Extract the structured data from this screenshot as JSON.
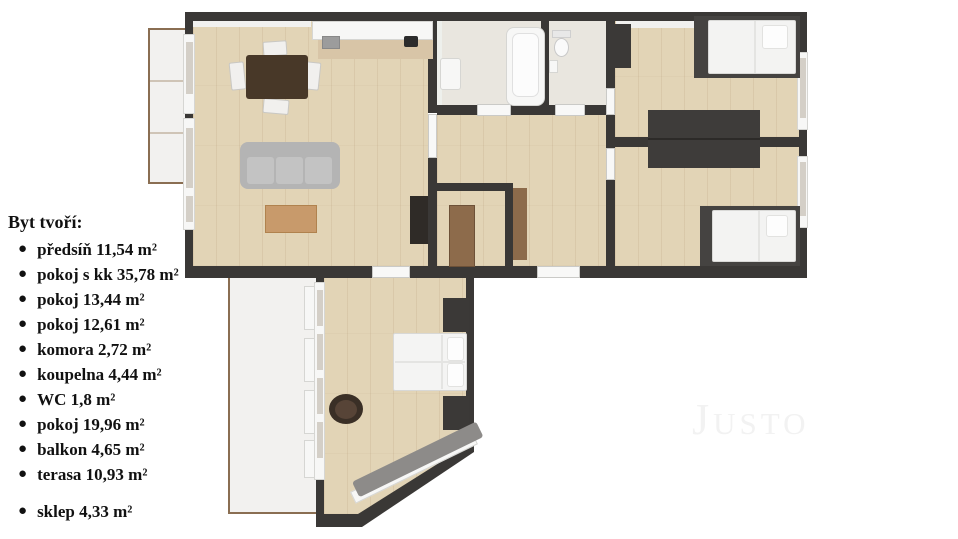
{
  "legend": {
    "title": "Byt tvoří:",
    "bullet": "●",
    "items": [
      {
        "label": "předsíň 11,54 m²"
      },
      {
        "label": "pokoj s kk 35,78 m²"
      },
      {
        "label": "pokoj 13,44 m²"
      },
      {
        "label": "pokoj 12,61 m²"
      },
      {
        "label": "komora 2,72 m²"
      },
      {
        "label": "koupelna 4,44 m²"
      },
      {
        "label": "WC 1,8 m²"
      },
      {
        "label": "pokoj 19,96 m²"
      },
      {
        "label": "balkon 4,65 m²"
      },
      {
        "label": "terasa 10,93 m²"
      },
      {
        "label": "sklep 4,33 m²"
      }
    ]
  },
  "watermark": "Justo",
  "colors": {
    "wall": "#3a3836",
    "wood_floor": "#e2d4b6",
    "bath_floor": "#e9e6df",
    "terrace_floor": "#f2f1ef",
    "terrace_border": "#8a6e52",
    "text": "#111111",
    "watermark": "#f2f2f2"
  }
}
